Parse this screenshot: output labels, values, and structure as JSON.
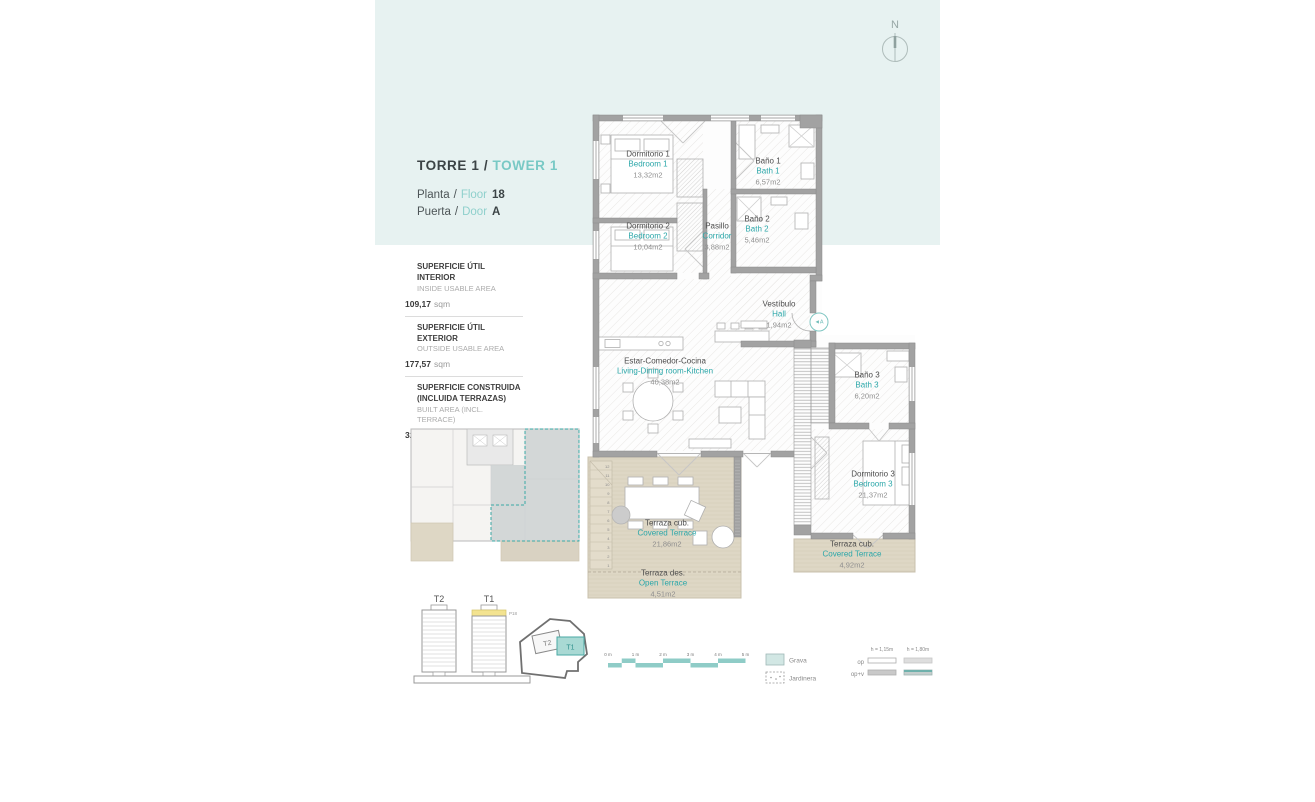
{
  "header": {
    "north": "N"
  },
  "title": {
    "es": "TORRE 1 /",
    "en": "TOWER 1"
  },
  "info": {
    "planta": "Planta",
    "sep": "/",
    "floor": "Floor",
    "floor_value": "18",
    "puerta": "Puerta",
    "door": "Door",
    "door_value": "A"
  },
  "areas": {
    "interior": {
      "es": "SUPERFICIE ÚTIL INTERIOR",
      "en": "INSIDE USABLE AREA",
      "value": "109,17",
      "unit": "sqm"
    },
    "exterior": {
      "es": "SUPERFICIE ÚTIL EXTERIOR",
      "en": "OUTSIDE USABLE AREA",
      "value": "177,57",
      "unit": "sqm"
    },
    "built": {
      "es": "SUPERFICIE CONSTRUIDA (INCLUIDA TERRAZAS)",
      "en": "BUILT AREA (INCL. TERRACE)",
      "value": "320,50",
      "unit": "sqm"
    }
  },
  "rooms": {
    "bedroom1": {
      "es": "Dormitorio 1",
      "en": "Bedroom 1",
      "area": "13,32m2"
    },
    "bath1": {
      "es": "Baño 1",
      "en": "Bath 1",
      "area": "6,57m2"
    },
    "bedroom2": {
      "es": "Dormitorio 2",
      "en": "Bedroom 2",
      "area": "10,04m2"
    },
    "corridor": {
      "es": "Pasillo",
      "en": "Corridor",
      "area": "3,88m2"
    },
    "bath2": {
      "es": "Baño 2",
      "en": "Bath 2",
      "area": "5,46m2"
    },
    "hall": {
      "es": "Vestíbulo",
      "en": "Hall",
      "area": "1,94m2"
    },
    "living": {
      "es": "Estar-Comedor-Cocina",
      "en": "Living-Dining room-Kitchen",
      "area": "40,38m2"
    },
    "bath3": {
      "es": "Baño 3",
      "en": "Bath 3",
      "area": "6,20m2"
    },
    "bedroom3": {
      "es": "Dormitorio 3",
      "en": "Bedroom 3",
      "area": "21,37m2"
    },
    "covered_terrace": {
      "es": "Terraza cub.",
      "en": "Covered Terrace",
      "area": "21,86m2"
    },
    "open_terrace": {
      "es": "Terraza des.",
      "en": "Open Terrace",
      "area": "4,51m2"
    },
    "covered_terrace_3": {
      "es": "Terraza cub.",
      "en": "Covered Terrace",
      "area": "4,92m2"
    }
  },
  "plan": {
    "entry_badge": "◄A",
    "stairs": [
      "12",
      "11",
      "10",
      "9",
      "8",
      "7",
      "6",
      "5",
      "4",
      "3",
      "2",
      "1"
    ]
  },
  "towers": {
    "t2": "T2",
    "t1": "T1",
    "floor_tag": "P18"
  },
  "site": {
    "t2": "T2",
    "t1": "T1"
  },
  "scalebar": {
    "labels": [
      "0 m",
      "1 m",
      "2 m",
      "3 m",
      "4 m",
      "5 m"
    ]
  },
  "legend": {
    "grava": "Grava",
    "jardinera": "Jardinera",
    "op": "op",
    "opv": "op+v",
    "h115": "h = 1,15m",
    "h180": "h = 1,80m"
  },
  "colors": {
    "accent_teal": "#2ba7a9",
    "light_teal": "#79c9c5",
    "panel_blue": "#e7f2f1",
    "wall_gray": "#a2a2a2",
    "terrace_beige": "#ded7c5",
    "highlight_yellow": "#f3e390"
  }
}
